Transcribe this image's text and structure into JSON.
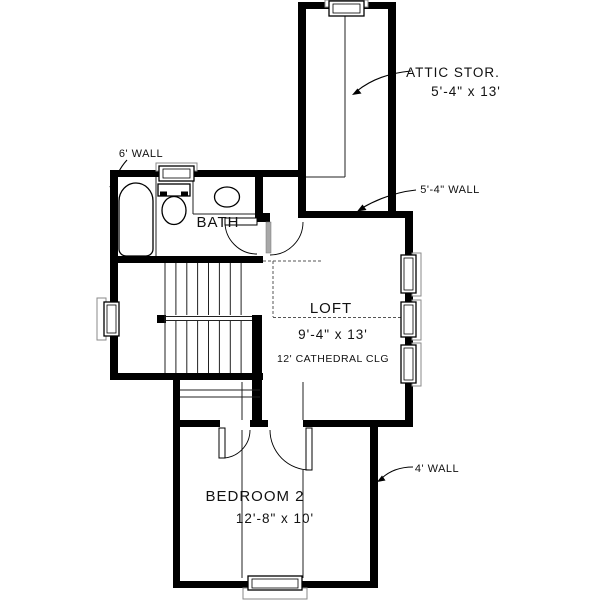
{
  "floor_plan": {
    "background": "#ffffff",
    "wall_color": "#000000",
    "door_leaf_color": "#a8a8a8",
    "rooms": {
      "attic_storage": {
        "label": "ATTIC STOR.",
        "dims": "5'-4\" x 13'"
      },
      "bath": {
        "label": "BATH"
      },
      "loft": {
        "label": "LOFT",
        "dims": "9'-4\" x 13'",
        "ceiling_note": "12' CATHEDRAL CLG"
      },
      "bedroom_2": {
        "label": "BEDROOM 2",
        "dims": "12'-8\" x 10'"
      }
    },
    "wall_annotations": {
      "six_ft": "6' WALL",
      "five_four_ft": "5'-4\" WALL",
      "four_ft": "4' WALL"
    }
  }
}
